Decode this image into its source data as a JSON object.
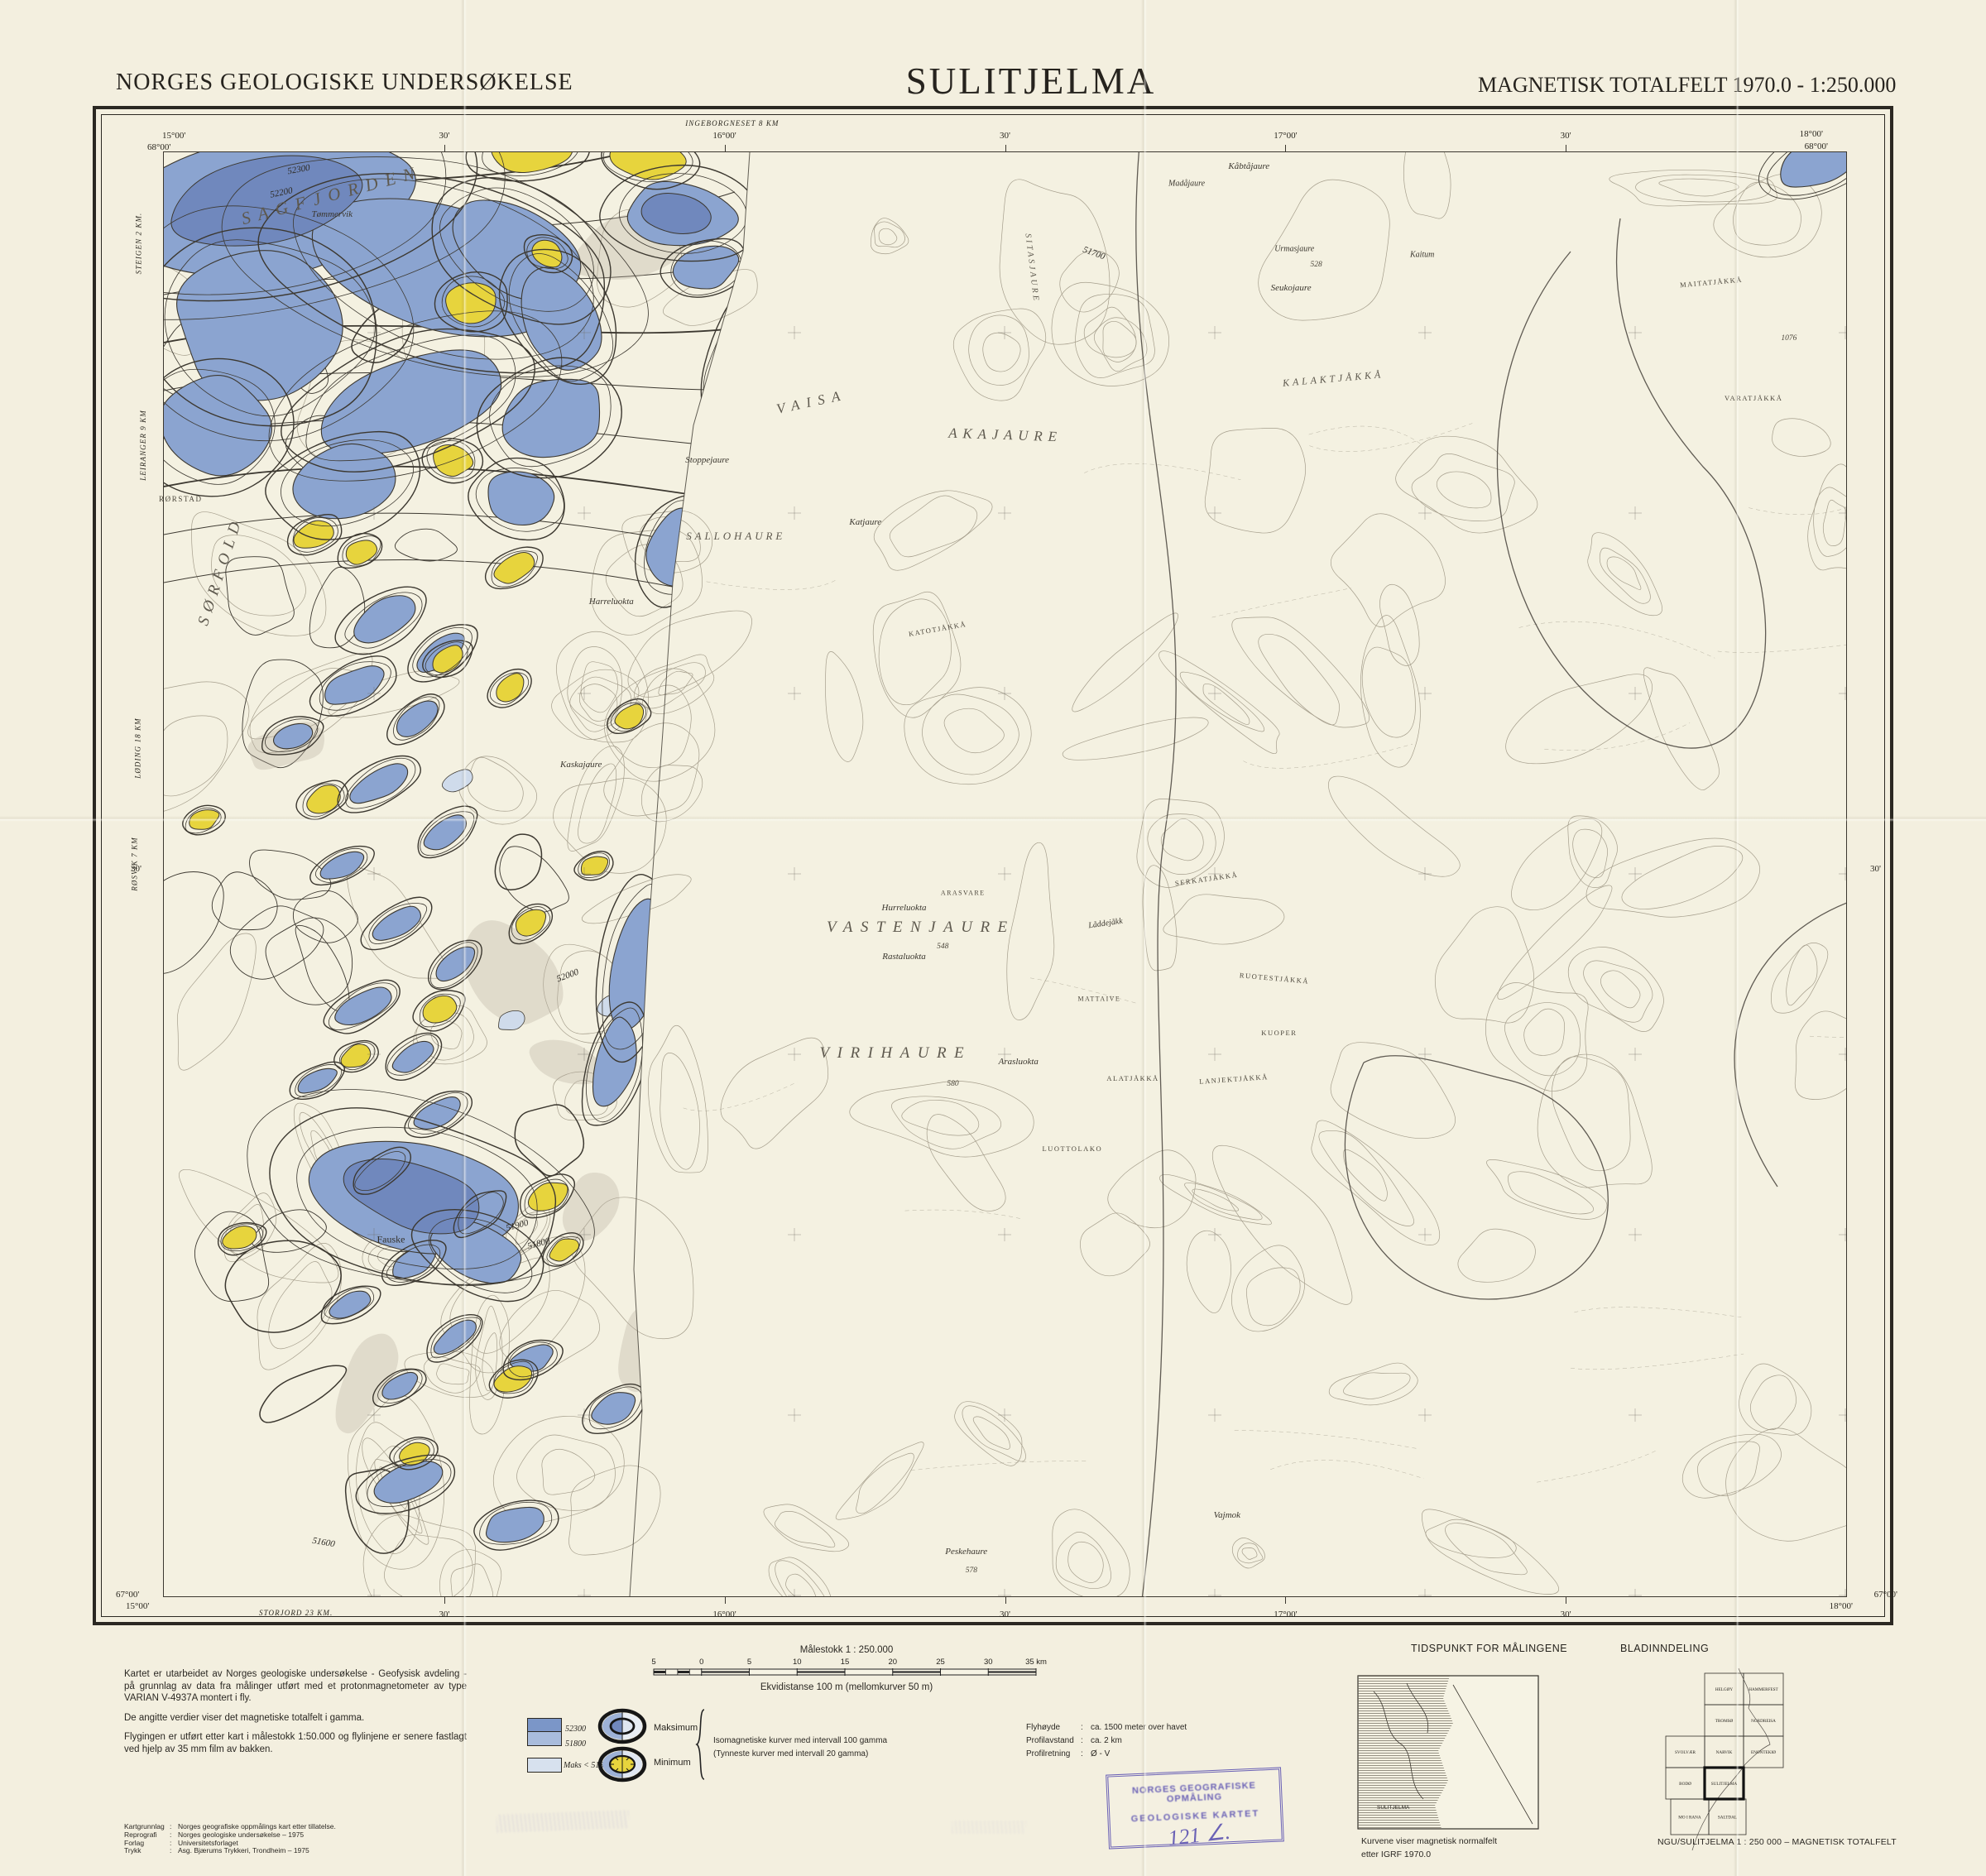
{
  "header": {
    "agency": "NORGES GEOLOGISKE UNDERSØKELSE",
    "title": "SULITJELMA",
    "edition": "MAGNETISK TOTALFELT 1970.0 - 1:250.000"
  },
  "map": {
    "corners": {
      "tl_lon": "15°00'",
      "tl_lat": "68°00'",
      "tr_lon": "18°00'",
      "tr_lat": "68°00'",
      "bl_lat": "67°00'",
      "bl_lon": "15°00'",
      "br_lon": "18°00'",
      "br_lat": "67°00'"
    },
    "mid": {
      "left": "30'",
      "right": "30'"
    },
    "ticks": [
      {
        "t": "30'",
        "x": 16.67
      },
      {
        "t": "16°00'",
        "x": 33.33
      },
      {
        "t": "30'",
        "x": 50
      },
      {
        "t": "17°00'",
        "x": 66.67
      },
      {
        "t": "30'",
        "x": 83.33
      }
    ],
    "notes": {
      "top": "INGEBORGNESET 8 KM",
      "bottom": "STORJORD 23 KM.",
      "left": [
        {
          "t": "STEIGEN 2 KM.",
          "y": 6
        },
        {
          "t": "LEIRANGER 9 KM",
          "y": 20
        },
        {
          "t": "LØDING 18 KM",
          "y": 41
        },
        {
          "t": "RØSVIK 7 KM",
          "y": 49
        }
      ]
    },
    "labels": [
      {
        "t": "SAGFJORDEN",
        "x": 10,
        "y": 3,
        "c": "big",
        "r": -15,
        "fs": 21,
        "ls": 0.45
      },
      {
        "t": "SØRFOLD",
        "x": 3.4,
        "y": 29,
        "c": "big",
        "r": -72,
        "fs": 19,
        "ls": 0.4
      },
      {
        "t": "VAISA",
        "x": 38.5,
        "y": 17.3,
        "c": "big",
        "r": -12,
        "fs": 17,
        "ls": 0.5
      },
      {
        "t": "AKAJAURE",
        "x": 50,
        "y": 19.6,
        "c": "big",
        "r": 2,
        "fs": 17,
        "ls": 0.4
      },
      {
        "t": "SALLOHAURE",
        "x": 34,
        "y": 26.6,
        "c": "big",
        "fs": 13,
        "ls": 0.3
      },
      {
        "t": "VASTENJAURE",
        "x": 45,
        "y": 53.7,
        "c": "big",
        "fs": 19,
        "ls": 0.5
      },
      {
        "t": "VIRIHAURE",
        "x": 43.5,
        "y": 62.4,
        "c": "big",
        "fs": 19,
        "ls": 0.5
      },
      {
        "t": "KALAKTJÅKKÅ",
        "x": 69.5,
        "y": 15.7,
        "c": "big",
        "r": -5,
        "fs": 12,
        "ls": 0.32
      },
      {
        "t": "SITASJAURE",
        "x": 51.6,
        "y": 8,
        "c": "big",
        "r": 83,
        "fs": 10,
        "ls": 0.3
      },
      {
        "t": "Tømmervik",
        "x": 10,
        "y": 4.3,
        "c": "name"
      },
      {
        "t": "Kåbtåjaure",
        "x": 64.5,
        "y": 1,
        "c": "name"
      },
      {
        "t": "Madåjaure",
        "x": 60.8,
        "y": 2.2,
        "c": "name",
        "fs": 10
      },
      {
        "t": "Stoppejaure",
        "x": 32.3,
        "y": 21.3,
        "c": "name"
      },
      {
        "t": "Katjaure",
        "x": 41.7,
        "y": 25.6,
        "c": "name"
      },
      {
        "t": "Harreluokta",
        "x": 26.6,
        "y": 31.1,
        "c": "name"
      },
      {
        "t": "Kaskajaure",
        "x": 24.8,
        "y": 42.4,
        "c": "name"
      },
      {
        "t": "Hurreluokta",
        "x": 44,
        "y": 52.3,
        "c": "name"
      },
      {
        "t": "Rastaluokta",
        "x": 44,
        "y": 55.7,
        "c": "name"
      },
      {
        "t": "Arasluokta",
        "x": 50.8,
        "y": 63,
        "c": "name"
      },
      {
        "t": "Seukojaure",
        "x": 67,
        "y": 9.4,
        "c": "name"
      },
      {
        "t": "Urmasjaure",
        "x": 67.2,
        "y": 6.7,
        "c": "name",
        "fs": 10
      },
      {
        "t": "Kaitum",
        "x": 74.8,
        "y": 7.1,
        "c": "name",
        "fs": 10
      },
      {
        "t": "Låddejåkk",
        "x": 56,
        "y": 53.4,
        "c": "name",
        "r": -8,
        "fs": 10
      },
      {
        "t": "Peskehaure",
        "x": 47.7,
        "y": 96.9,
        "c": "name"
      },
      {
        "t": "Vajmok",
        "x": 63.2,
        "y": 94.4,
        "c": "name"
      },
      {
        "t": "Fauske",
        "x": 13.5,
        "y": 75.3,
        "c": "town"
      },
      {
        "t": "RØRSTAD",
        "x": 1,
        "y": 24,
        "c": "cap",
        "fs": 9
      },
      {
        "t": "ARASVARE",
        "x": 47.5,
        "y": 51.3,
        "c": "cap",
        "fs": 8
      },
      {
        "t": "MATTAIVE",
        "x": 55.6,
        "y": 58.6,
        "c": "cap",
        "fs": 8
      },
      {
        "t": "SERKATJÅKKÅ",
        "x": 62,
        "y": 50.3,
        "c": "cap",
        "r": -8
      },
      {
        "t": "RUOTESTJÅKKÅ",
        "x": 66,
        "y": 57.2,
        "c": "cap",
        "r": 5
      },
      {
        "t": "KUOPER",
        "x": 66.3,
        "y": 61,
        "c": "cap"
      },
      {
        "t": "LANJEKTJÅKKÅ",
        "x": 63.6,
        "y": 64.2,
        "c": "cap",
        "r": -4
      },
      {
        "t": "ALATJÅKKÅ",
        "x": 57.6,
        "y": 64.1,
        "c": "cap"
      },
      {
        "t": "KATOTJÅKKÅ",
        "x": 46,
        "y": 33,
        "c": "cap",
        "r": -10
      },
      {
        "t": "MAITATJÅKKÅ",
        "x": 92,
        "y": 9,
        "c": "cap",
        "r": -5
      },
      {
        "t": "VARATJÅKKÅ",
        "x": 94.5,
        "y": 17,
        "c": "cap"
      },
      {
        "t": "LUOTTOLAKO",
        "x": 54,
        "y": 69,
        "c": "cap"
      },
      {
        "t": "52300",
        "x": 8,
        "y": 1.2,
        "c": "val",
        "r": -10
      },
      {
        "t": "52200",
        "x": 7,
        "y": 2.8,
        "c": "val",
        "r": -12
      },
      {
        "t": "51900",
        "x": 21,
        "y": 74.3,
        "c": "val",
        "r": -15
      },
      {
        "t": "51800",
        "x": 22.3,
        "y": 75.6,
        "c": "val",
        "r": -15
      },
      {
        "t": "51700",
        "x": 55.3,
        "y": 7,
        "c": "val",
        "r": 20
      },
      {
        "t": "51600",
        "x": 9.5,
        "y": 96.3,
        "c": "val",
        "r": 10
      },
      {
        "t": "52000",
        "x": 24,
        "y": 57,
        "c": "val",
        "r": -20
      },
      {
        "t": "548",
        "x": 46.3,
        "y": 55,
        "c": "num"
      },
      {
        "t": "580",
        "x": 46.9,
        "y": 64.5,
        "c": "num"
      },
      {
        "t": "578",
        "x": 48,
        "y": 98.2,
        "c": "num"
      },
      {
        "t": "528",
        "x": 68.5,
        "y": 7.8,
        "c": "num"
      },
      {
        "t": "1076",
        "x": 96.6,
        "y": 12.9,
        "c": "num"
      }
    ]
  },
  "footer": {
    "about": [
      "Kartet er utarbeidet av Norges geologiske undersøkelse - Geofysisk avdeling - på grunnlag av data fra målinger utført med et protonmagnetometer av type VARIAN V-4937A montert i fly.",
      "De angitte verdier viser det magnetiske totalfelt i gamma.",
      "Flygingen er utført etter kart i målestokk 1:50.000 og flylinjene er senere fastlagt ved hjelp av 35 mm film av bakken."
    ],
    "credits": [
      {
        "label": "Kartgrunnlag",
        "value": "Norges geografiske oppmålings kart etter tillatelse."
      },
      {
        "label": "Reprografi",
        "value": "Norges geologiske undersøkelse – 1975"
      },
      {
        "label": "Forlag",
        "value": "Universitetsforlaget"
      },
      {
        "label": "Trykk",
        "value": "Asg. Bjærums Trykkeri, Trondheim – 1975"
      }
    ],
    "scale": {
      "title": "Målestokk 1 : 250.000",
      "numbers": [
        "5",
        "0",
        "5",
        "10",
        "15",
        "20",
        "25",
        "30",
        "35 km"
      ],
      "equidistance": "Ekvidistanse 100 m (mellomkurver 50 m)"
    },
    "legend": {
      "value_upper": "52300",
      "value_lower": "51800",
      "maks_label": "Maks < 51800",
      "maksimum": "Maksimum",
      "minimum": "Minimum",
      "iso_line1": "Isomagnetiske kurver med intervall 100 gamma",
      "iso_line2": "(Tynneste kurver med intervall 20 gamma)"
    },
    "flight": [
      {
        "label": "Flyhøyde",
        "value": "ca. 1500 meter over havet"
      },
      {
        "label": "Profilavstand",
        "value": "ca. 2 km"
      },
      {
        "label": "Profilretning",
        "value": "Ø - V"
      }
    ],
    "stamp": {
      "line1": "NORGES GEOGRAFISKE OPMÅLING",
      "line2": "GEOLOGISKE KARTET",
      "number": "121 ∠."
    },
    "tidspunkt": {
      "title": "TIDSPUNKT FOR MÅLINGENE",
      "inset_label": "SULITJELMA",
      "caption1": "Kurvene viser magnetisk normalfelt",
      "caption2": "etter IGRF 1970.0"
    },
    "blad": {
      "title": "BLADINNDELING",
      "sheets": [
        "HELGØY",
        "HAMMERFEST",
        "TROMSØ",
        "NORDREISA",
        "SVOLVÆR",
        "NARVIK",
        "ENONTEKIØ",
        "BODØ",
        "SULITJELMA",
        "MO I RANA",
        "SALTDAL"
      ],
      "caption": "NGU/SULITJELMA 1 : 250 000 – MAGNETISK TOTALFELT"
    }
  },
  "colors": {
    "paper": "#f3efdf",
    "anomaly_blue": "#8ba4d0",
    "anomaly_blue_dark": "#7088bd",
    "anomaly_blue_pale": "#cfdbeb",
    "anomaly_yellow": "#e7d43d",
    "contour_dark": "#3c3830",
    "contour_light": "#a59e8c",
    "stamp_blue": "#584eb0"
  }
}
